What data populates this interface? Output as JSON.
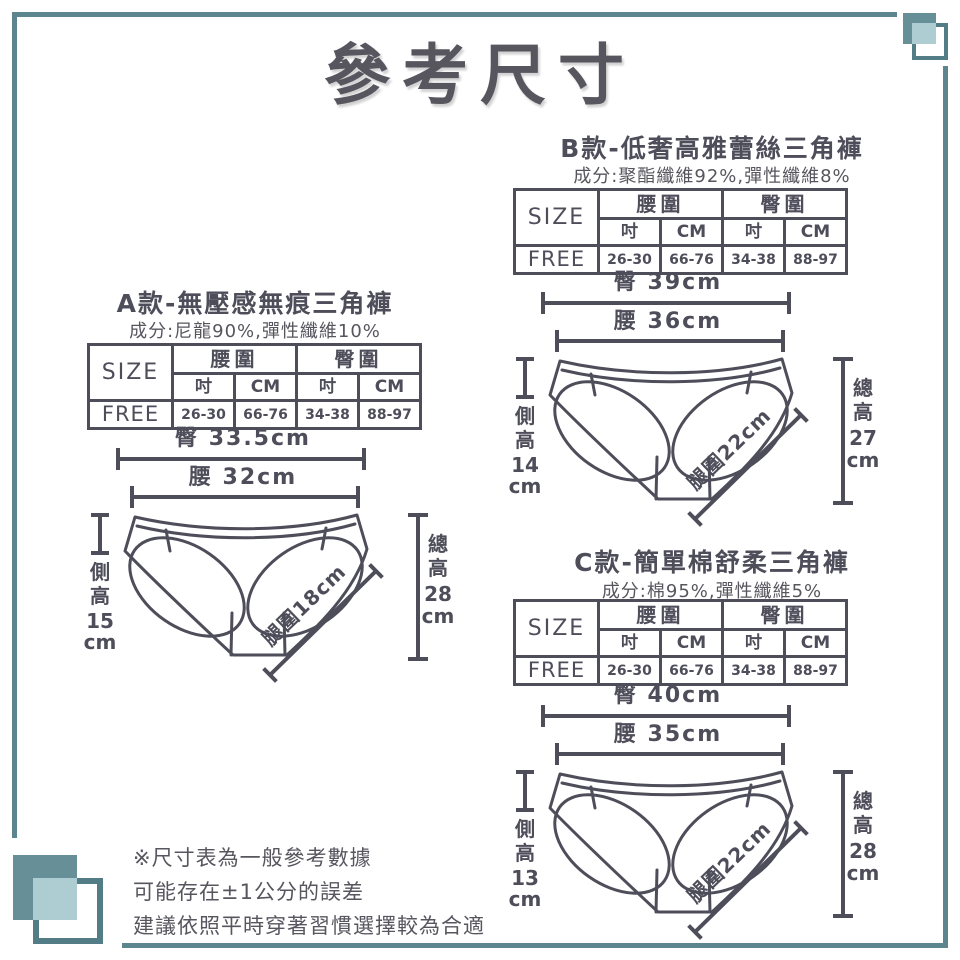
{
  "title": "參考尺寸",
  "colors": {
    "ink": "#4e4d5a",
    "teal": "#678f98",
    "teal_light": "#aecdd2",
    "frame": "#5d858d"
  },
  "sections": [
    {
      "name": "A",
      "heading": "A款-無壓感無痕三角褲",
      "composition": "成分:尼龍90%,彈性纖維10%",
      "table": {
        "size_label": "SIZE",
        "waist_header": "腰圍",
        "hip_header": "臀圍",
        "inch": "吋",
        "cm": "CM",
        "row_label": "FREE",
        "waist_inch": "26-30",
        "waist_cm": "66-76",
        "hip_inch": "34-38",
        "hip_cm": "88-97"
      },
      "diagram": {
        "hip": "臀 33.5cm",
        "waist": "腰 32cm",
        "side": [
          "側",
          "高",
          "15",
          "cm"
        ],
        "total": [
          "總",
          "高",
          "28",
          "cm"
        ],
        "leg": "腿圍18cm"
      }
    },
    {
      "name": "B",
      "heading": "B款-低奢高雅蕾絲三角褲",
      "composition": "成分:聚酯纖維92%,彈性纖維8%",
      "table": {
        "size_label": "SIZE",
        "waist_header": "腰圍",
        "hip_header": "臀圍",
        "inch": "吋",
        "cm": "CM",
        "row_label": "FREE",
        "waist_inch": "26-30",
        "waist_cm": "66-76",
        "hip_inch": "34-38",
        "hip_cm": "88-97"
      },
      "diagram": {
        "hip": "臀 39cm",
        "waist": "腰 36cm",
        "side": [
          "側",
          "高",
          "14",
          "cm"
        ],
        "total": [
          "總",
          "高",
          "27",
          "cm"
        ],
        "leg": "腿圍22cm"
      }
    },
    {
      "name": "C",
      "heading": "C款-簡單棉舒柔三角褲",
      "composition": "成分:棉95%,彈性纖維5%",
      "table": {
        "size_label": "SIZE",
        "waist_header": "腰圍",
        "hip_header": "臀圍",
        "inch": "吋",
        "cm": "CM",
        "row_label": "FREE",
        "waist_inch": "26-30",
        "waist_cm": "66-76",
        "hip_inch": "34-38",
        "hip_cm": "88-97"
      },
      "diagram": {
        "hip": "臀 40cm",
        "waist": "腰 35cm",
        "side": [
          "側",
          "高",
          "13",
          "cm"
        ],
        "total": [
          "總",
          "高",
          "28",
          "cm"
        ],
        "leg": "腿圍22cm"
      }
    }
  ],
  "note": [
    "※尺寸表為一般參考數據",
    "可能存在±1公分的誤差",
    "建議依照平時穿著習慣選擇較為合適"
  ]
}
